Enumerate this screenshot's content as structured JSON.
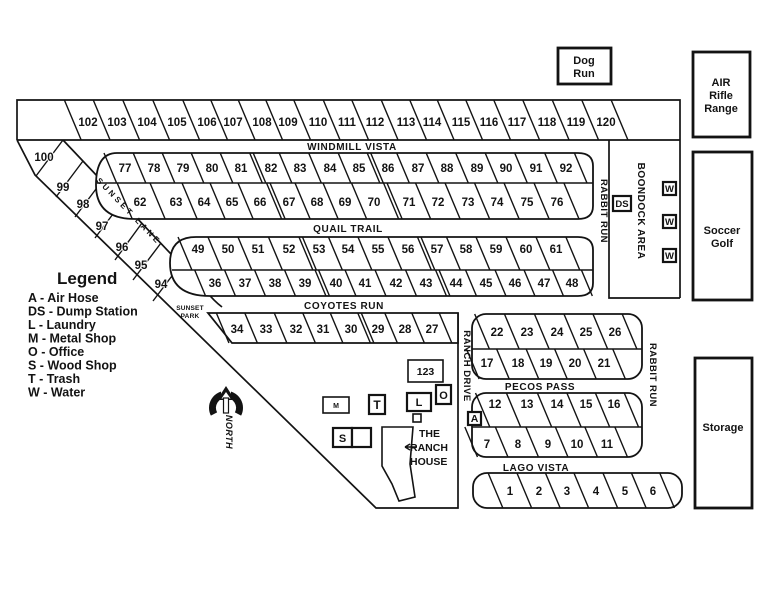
{
  "legend": {
    "title": "Legend",
    "items": [
      "A - Air Hose",
      "DS - Dump Station",
      "L - Laundry",
      "M - Metal Shop",
      "O - Office",
      "S - Wood Shop",
      "T - Trash",
      "W - Water"
    ]
  },
  "streets": {
    "windmill_vista": "WINDMILL VISTA",
    "quail_trail": "QUAIL TRAIL",
    "coyotes_run": "COYOTES RUN",
    "pecos_pass": "PECOS PASS",
    "lago_vista": "LAGO VISTA",
    "sunset_lane": "SUNSET LANE",
    "ranch_drive": "RANCH DRIVE",
    "rabbit_run_upper": "RABBIT RUN",
    "rabbit_run_lower": "RABBIT RUN"
  },
  "areas": {
    "dog_run": [
      "Dog",
      "Run"
    ],
    "air_rifle_range": [
      "AIR",
      "Rifle",
      "Range"
    ],
    "soccer_golf": [
      "Soccer",
      "Golf"
    ],
    "storage": "Storage",
    "boondock_area": "BOONDOCK AREA",
    "sunset_park": [
      "SUNSET",
      "PARK"
    ],
    "ranch_house": [
      "THE",
      "RANCH",
      "HOUSE"
    ],
    "north_label": "NORTH",
    "office_unit": "123"
  },
  "markers": {
    "dump_station": "DS",
    "water": "W",
    "air_hose": "A",
    "metal_shop": "M",
    "trash": "T",
    "laundry": "L",
    "office": "O",
    "wood_shop": "S"
  },
  "rows": {
    "top": {
      "sites": [
        "102",
        "103",
        "104",
        "105",
        "106",
        "107",
        "108",
        "109",
        "110",
        "111",
        "112",
        "113",
        "114",
        "115",
        "116",
        "117",
        "118",
        "119",
        "120"
      ]
    },
    "windmill_upper": {
      "sites": [
        "77",
        "78",
        "79",
        "80",
        "81",
        "82",
        "83",
        "84",
        "85",
        "86",
        "87",
        "88",
        "89",
        "90",
        "91",
        "92"
      ]
    },
    "windmill_lower": {
      "sites": [
        "62",
        "63",
        "64",
        "65",
        "66",
        "67",
        "68",
        "69",
        "70",
        "71",
        "72",
        "73",
        "74",
        "75",
        "76"
      ]
    },
    "quail_upper": {
      "sites": [
        "49",
        "50",
        "51",
        "52",
        "53",
        "54",
        "55",
        "56",
        "57",
        "58",
        "59",
        "60",
        "61"
      ]
    },
    "quail_lower": {
      "sites": [
        "36",
        "37",
        "38",
        "39",
        "40",
        "41",
        "42",
        "43",
        "44",
        "45",
        "46",
        "47",
        "48"
      ]
    },
    "coyotes": {
      "sites": [
        "34",
        "33",
        "32",
        "31",
        "30",
        "29",
        "28",
        "27"
      ]
    },
    "pecos_upper": {
      "sites": [
        "22",
        "23",
        "24",
        "25",
        "26"
      ]
    },
    "pecos_lower": {
      "sites": [
        "17",
        "18",
        "19",
        "20",
        "21"
      ]
    },
    "lago_upper": {
      "sites": [
        "12",
        "13",
        "14",
        "15",
        "16"
      ]
    },
    "lago_lower": {
      "sites": [
        "7",
        "8",
        "9",
        "10",
        "11"
      ]
    },
    "lago_front": {
      "sites": [
        "1",
        "2",
        "3",
        "4",
        "5",
        "6"
      ]
    },
    "sunset_lane": {
      "sites": [
        "100",
        "99",
        "98",
        "97",
        "96",
        "95",
        "94"
      ]
    }
  },
  "colors": {
    "ink": "#131313",
    "background": "#ffffff"
  }
}
